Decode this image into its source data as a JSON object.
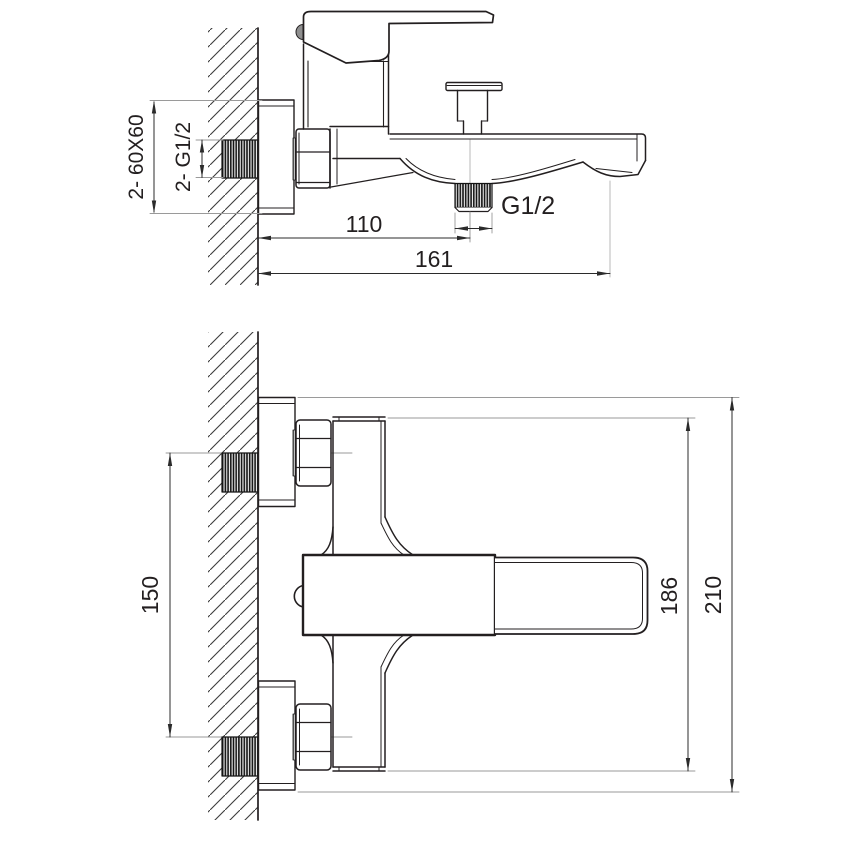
{
  "drawing": {
    "type": "technical-drawing",
    "subject": "wall-mounted bath shower mixer faucet, two orthographic views with dimensions",
    "background": "#ffffff",
    "line_color": "#231f20",
    "extension_line_color": "#9a9a9a",
    "views": {
      "side_view": {
        "label": "side view (upper drawing)",
        "dims": {
          "plate": "2- 60X60",
          "wall_thread": "2- G1/2",
          "shower_outlet_offset": "110",
          "overall_depth": "161",
          "shower_outlet_thread": "G1/2"
        }
      },
      "front_view": {
        "label": "front view (lower drawing)",
        "dims": {
          "inlet_spacing": "150",
          "body_height": "186",
          "overall_height": "210"
        }
      }
    }
  }
}
